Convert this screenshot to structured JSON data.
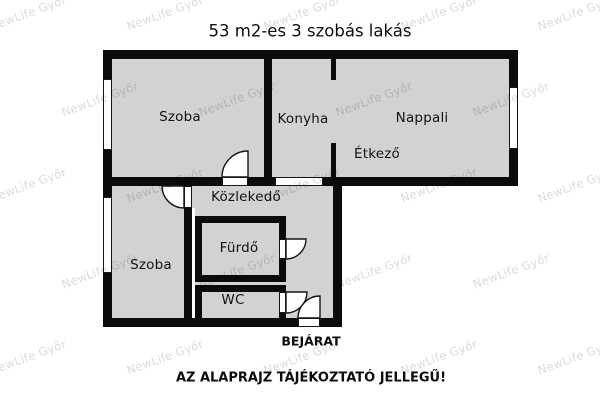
{
  "title": "53 m2-es 3 szobás lakás",
  "watermark": {
    "text": "NewLife Győr"
  },
  "plan": {
    "rooms": [
      {
        "id": "szoba-upper",
        "label": "Szoba"
      },
      {
        "id": "konyha",
        "label": "Konyha"
      },
      {
        "id": "nappali",
        "label": "Nappali"
      },
      {
        "id": "etkezo",
        "label": "Étkező"
      },
      {
        "id": "kozlekedo",
        "label": "Közlekedő"
      },
      {
        "id": "furdo",
        "label": "Fürdő"
      },
      {
        "id": "szoba-lower",
        "label": "Szoba"
      },
      {
        "id": "wc",
        "label": "WC"
      }
    ],
    "entrance_label": "BEJÁRAT"
  },
  "footer": {
    "disclaimer": "AZ ALAPRAJZ TÁJÉKOZTATÓ JELLEGŰ!"
  },
  "colors": {
    "background": "#ffffff",
    "room_fill": "#d2d2d2",
    "wall": "#0b0b0b",
    "watermark": "rgba(0,0,0,0.15)"
  }
}
